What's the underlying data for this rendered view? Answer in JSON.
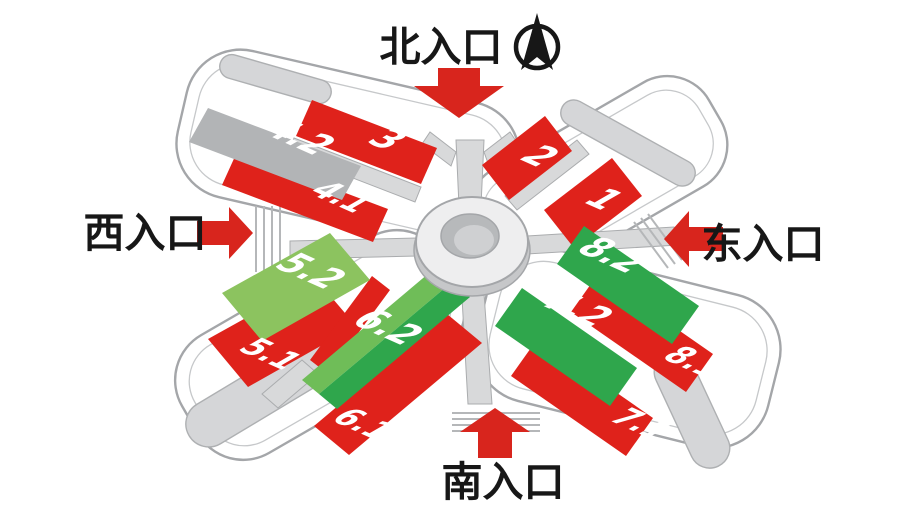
{
  "diagram": {
    "title": "exhibition-center-entrance-map",
    "entrances": {
      "north": "北入口",
      "west": "西入口",
      "east": "东入口",
      "south": "南入口"
    },
    "halls": {
      "h1": {
        "label": "1",
        "color": "red"
      },
      "h2": {
        "label": "2",
        "color": "red"
      },
      "h3": {
        "label": "3",
        "color": "red"
      },
      "h41": {
        "label": "4.1",
        "color": "red"
      },
      "h42": {
        "label": "4.2",
        "color": "gray"
      },
      "h51": {
        "label": "5.1",
        "color": "red"
      },
      "h52": {
        "label": "5.2",
        "color": "light-green"
      },
      "h61": {
        "label": "6.1",
        "color": "red"
      },
      "h62": {
        "label": "6.2",
        "color": "green"
      },
      "h71": {
        "label": "7.1",
        "color": "red"
      },
      "h72": {
        "label": "7.2",
        "color": "green"
      },
      "h81": {
        "label": "8.1",
        "color": "red"
      },
      "h82": {
        "label": "8.2",
        "color": "green"
      }
    },
    "colors": {
      "hall_red": "#df221b",
      "hall_green": "#2fa64c",
      "hall_light_green": "#8cc35f",
      "hall_mid_green": "#6fbd58",
      "hall_gray": "#b2b4b6",
      "arrow_red": "#d8251d",
      "canopy_gray": "#d5d6d8",
      "outline_gray": "#a4a6a9",
      "label_white": "#ffffff",
      "text_black": "#171717"
    },
    "icons": {
      "compass": "north-compass-icon"
    }
  }
}
